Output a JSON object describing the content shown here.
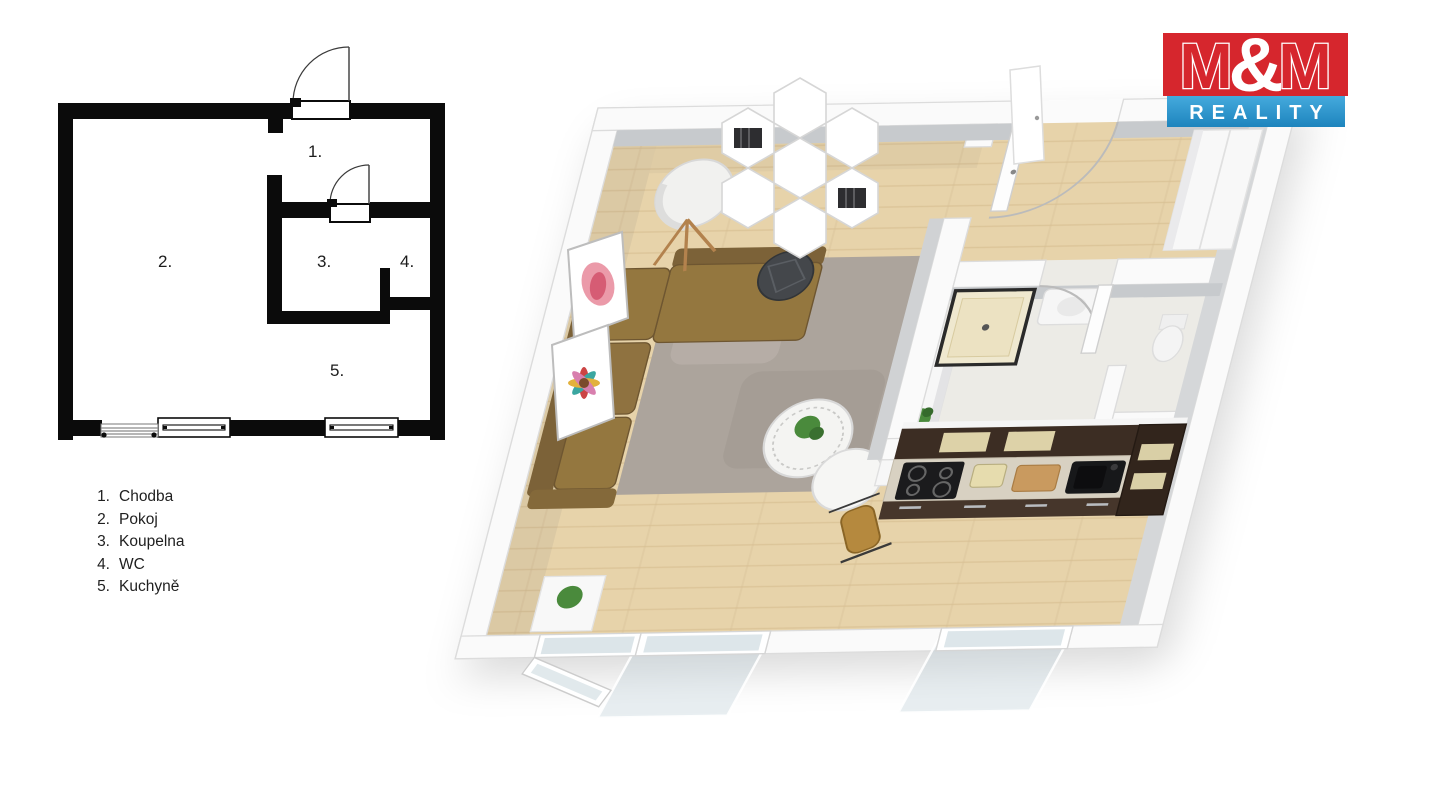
{
  "page": {
    "background": "#ffffff"
  },
  "logo": {
    "m1": "M",
    "amp": "&",
    "m2": "M",
    "reality": "REALITY",
    "red": "#d6262d",
    "blue_top": "#45aadd",
    "blue_bottom": "#1d84bd"
  },
  "plan2d": {
    "wall_color": "#0b0b0b",
    "labels": [
      {
        "text": "1."
      },
      {
        "text": "2."
      },
      {
        "text": "3."
      },
      {
        "text": "4."
      },
      {
        "text": "5."
      }
    ]
  },
  "legend": {
    "items": [
      {
        "num": "1.",
        "label": "Chodba"
      },
      {
        "num": "2.",
        "label": "Pokoj"
      },
      {
        "num": "3.",
        "label": "Koupelna"
      },
      {
        "num": "4.",
        "label": "WC"
      },
      {
        "num": "5.",
        "label": "Kuchyně"
      }
    ]
  },
  "palette": {
    "plan_black": "#0b0b0b",
    "wood_floor": "#e7d3aa",
    "wood_line": "#d9c093",
    "rug": "#aca49c",
    "sofa": "#94773f",
    "sofa_dark": "#7c6238",
    "pouf": "#44474b",
    "cabinet_dark": "#3c2d23",
    "counter": "#d8d1c2",
    "wall_white": "#fafafa",
    "wall_face_gray": "#c7cacd",
    "glass": "#dde6ea",
    "chair_mustard": "#b5893e",
    "plant_green": "#4a8a3c"
  }
}
